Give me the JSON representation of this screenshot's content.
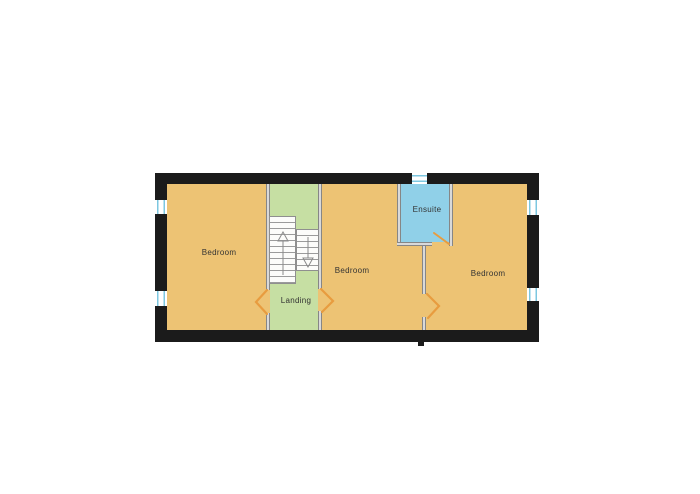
{
  "plan": {
    "title": "floor-plan",
    "rooms": {
      "bedroom_left": {
        "label": "Bedroom"
      },
      "landing": {
        "label": "Landing"
      },
      "bedroom_middle": {
        "label": "Bedroom"
      },
      "ensuite": {
        "label": "Ensuite"
      },
      "bedroom_right": {
        "label": "Bedroom"
      }
    },
    "features": {
      "stairs": {
        "up_flight": "up-arrow",
        "down_flight": "down-arrow"
      },
      "windows_count": 5,
      "door_swings_count": 4
    }
  },
  "colors": {
    "page_background": "#ffffff",
    "wall": "#1b1b1b",
    "floor": "#edc374",
    "landing": "#c6dfa3",
    "ensuite": "#90d0e8",
    "interior_wall_dark": "#868686",
    "interior_wall_light": "#d9d9d9",
    "window_glass": "#7cc7e0",
    "door_swing": "#e89c3f",
    "stair_tread": "#9b9b9b",
    "label_text": "#333333"
  }
}
